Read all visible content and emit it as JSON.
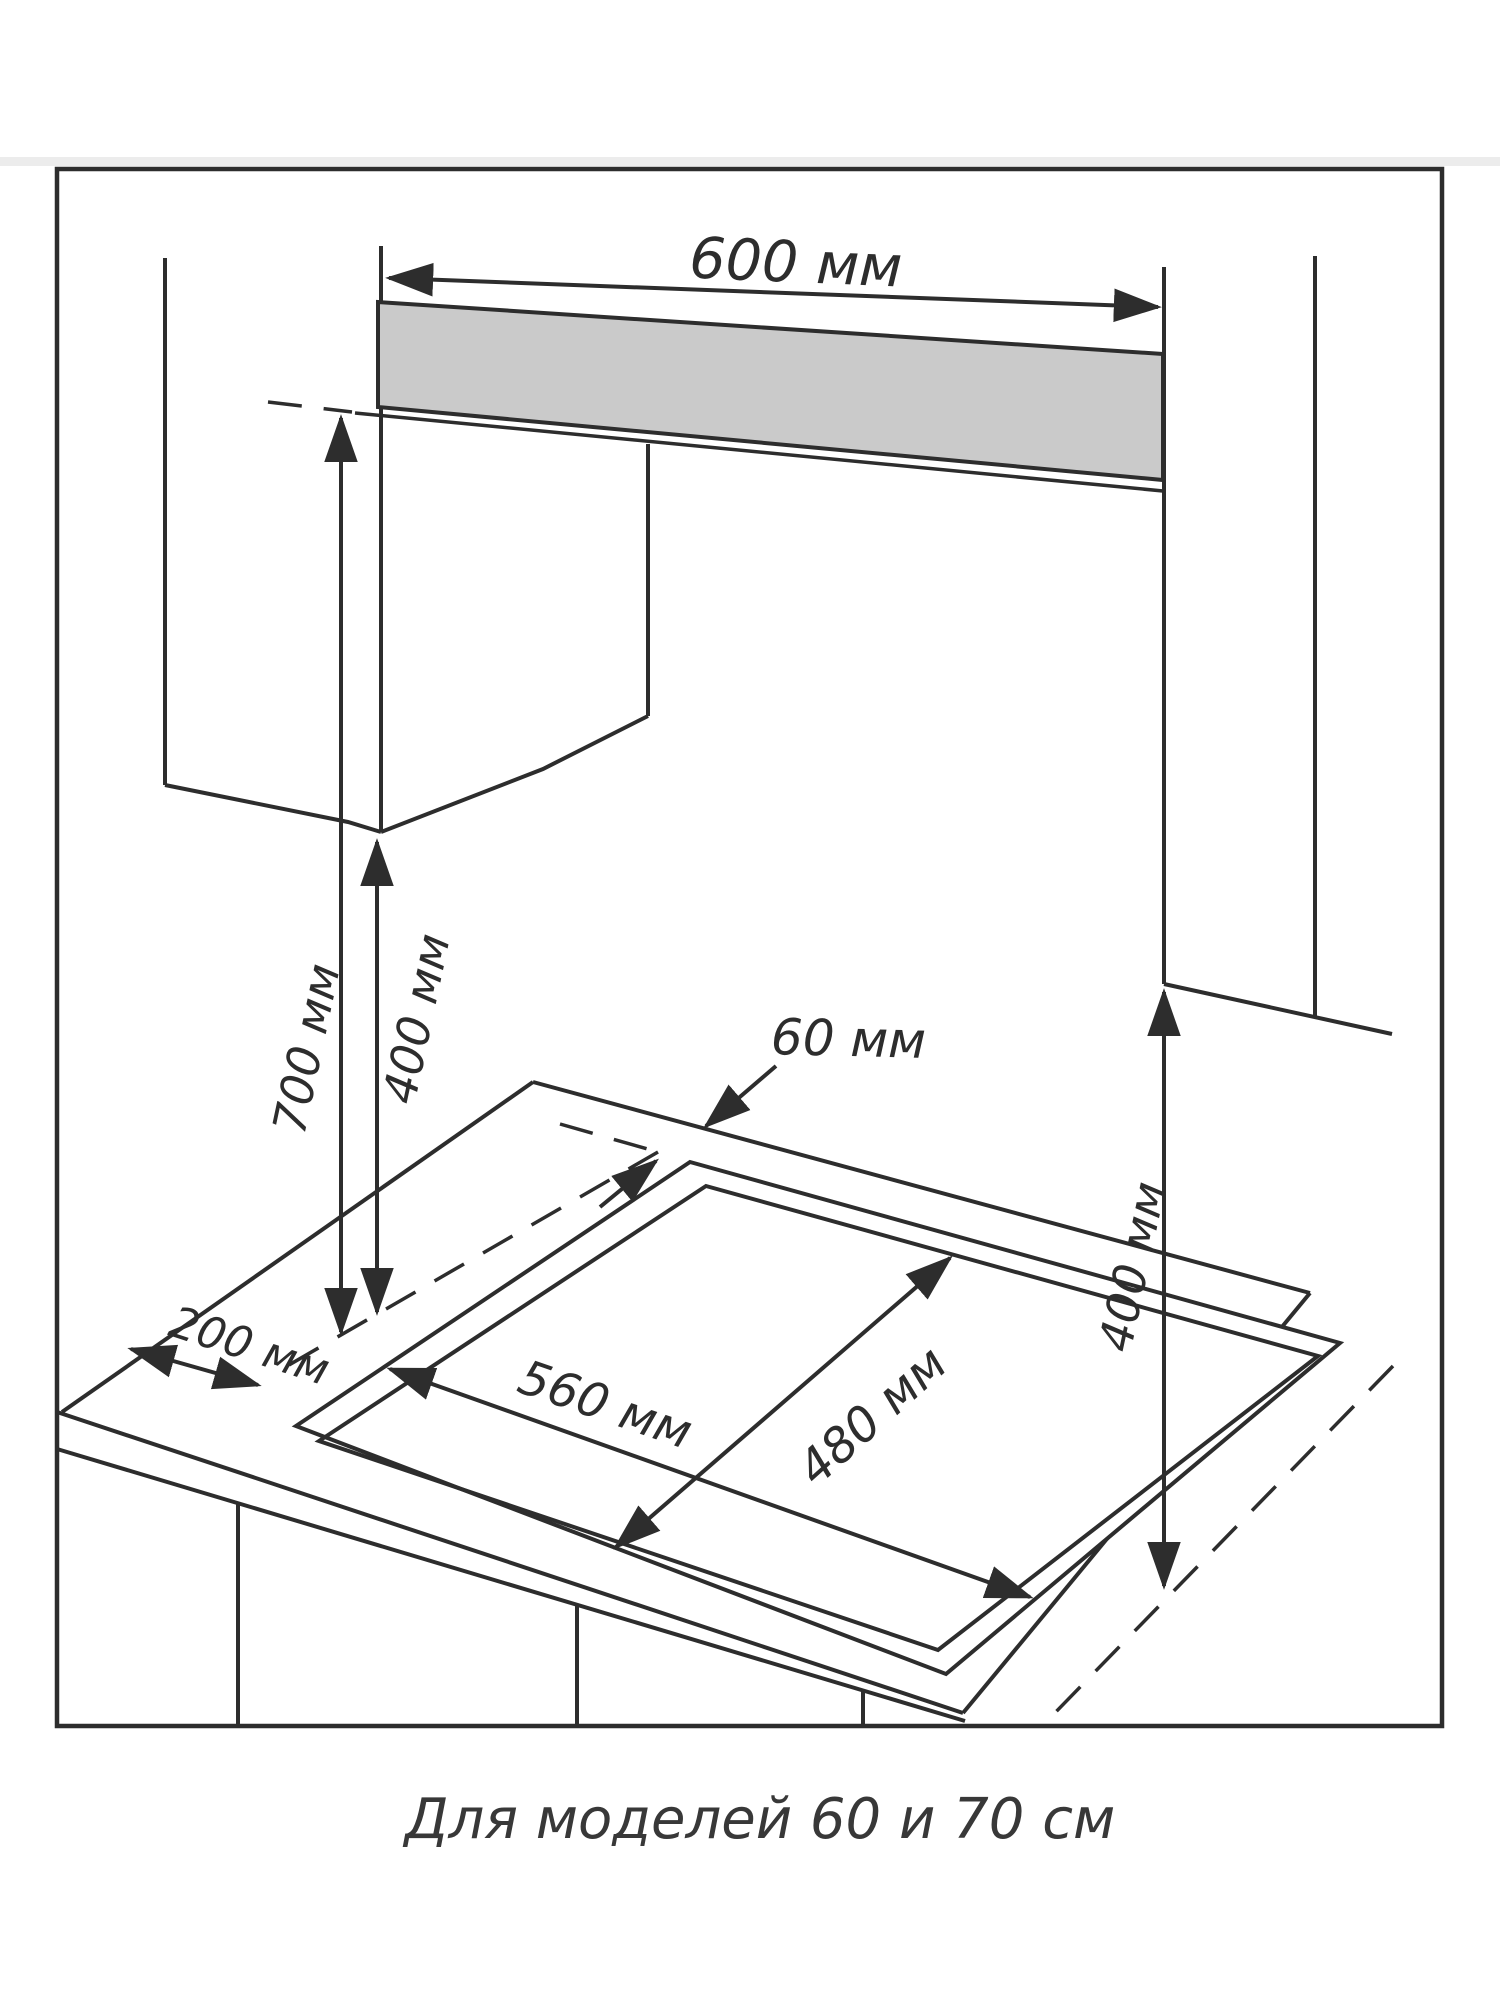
{
  "window": {
    "background": "#ffffff"
  },
  "diagram": {
    "type": "installation-drawing",
    "caption": "Для моделей 60 и 70 см",
    "colors": {
      "line": "#2d2d2d",
      "backsplash_fill": "#cacaca",
      "page_rule": "#ececec",
      "text": "#2d2d2d",
      "background": "#ffffff"
    },
    "dimensions": {
      "top_width": {
        "value": 600,
        "unit": "мм",
        "label": "600 мм"
      },
      "hood_clearance": {
        "value": 700,
        "unit": "мм",
        "label": "700 мм"
      },
      "left_cabinet_clearance": {
        "value": 400,
        "unit": "мм",
        "label": "400 мм"
      },
      "rear_wall_gap": {
        "value": 60,
        "unit": "мм",
        "label": "60 мм"
      },
      "left_side_gap": {
        "value": 200,
        "unit": "мм",
        "label": "200 мм"
      },
      "cutout_width": {
        "value": 560,
        "unit": "мм",
        "label": "560 мм"
      },
      "cutout_depth": {
        "value": 480,
        "unit": "мм",
        "label": "480 мм"
      },
      "right_cabinet_clearance": {
        "value": 400,
        "unit": "мм",
        "label": "400 мм"
      }
    }
  }
}
